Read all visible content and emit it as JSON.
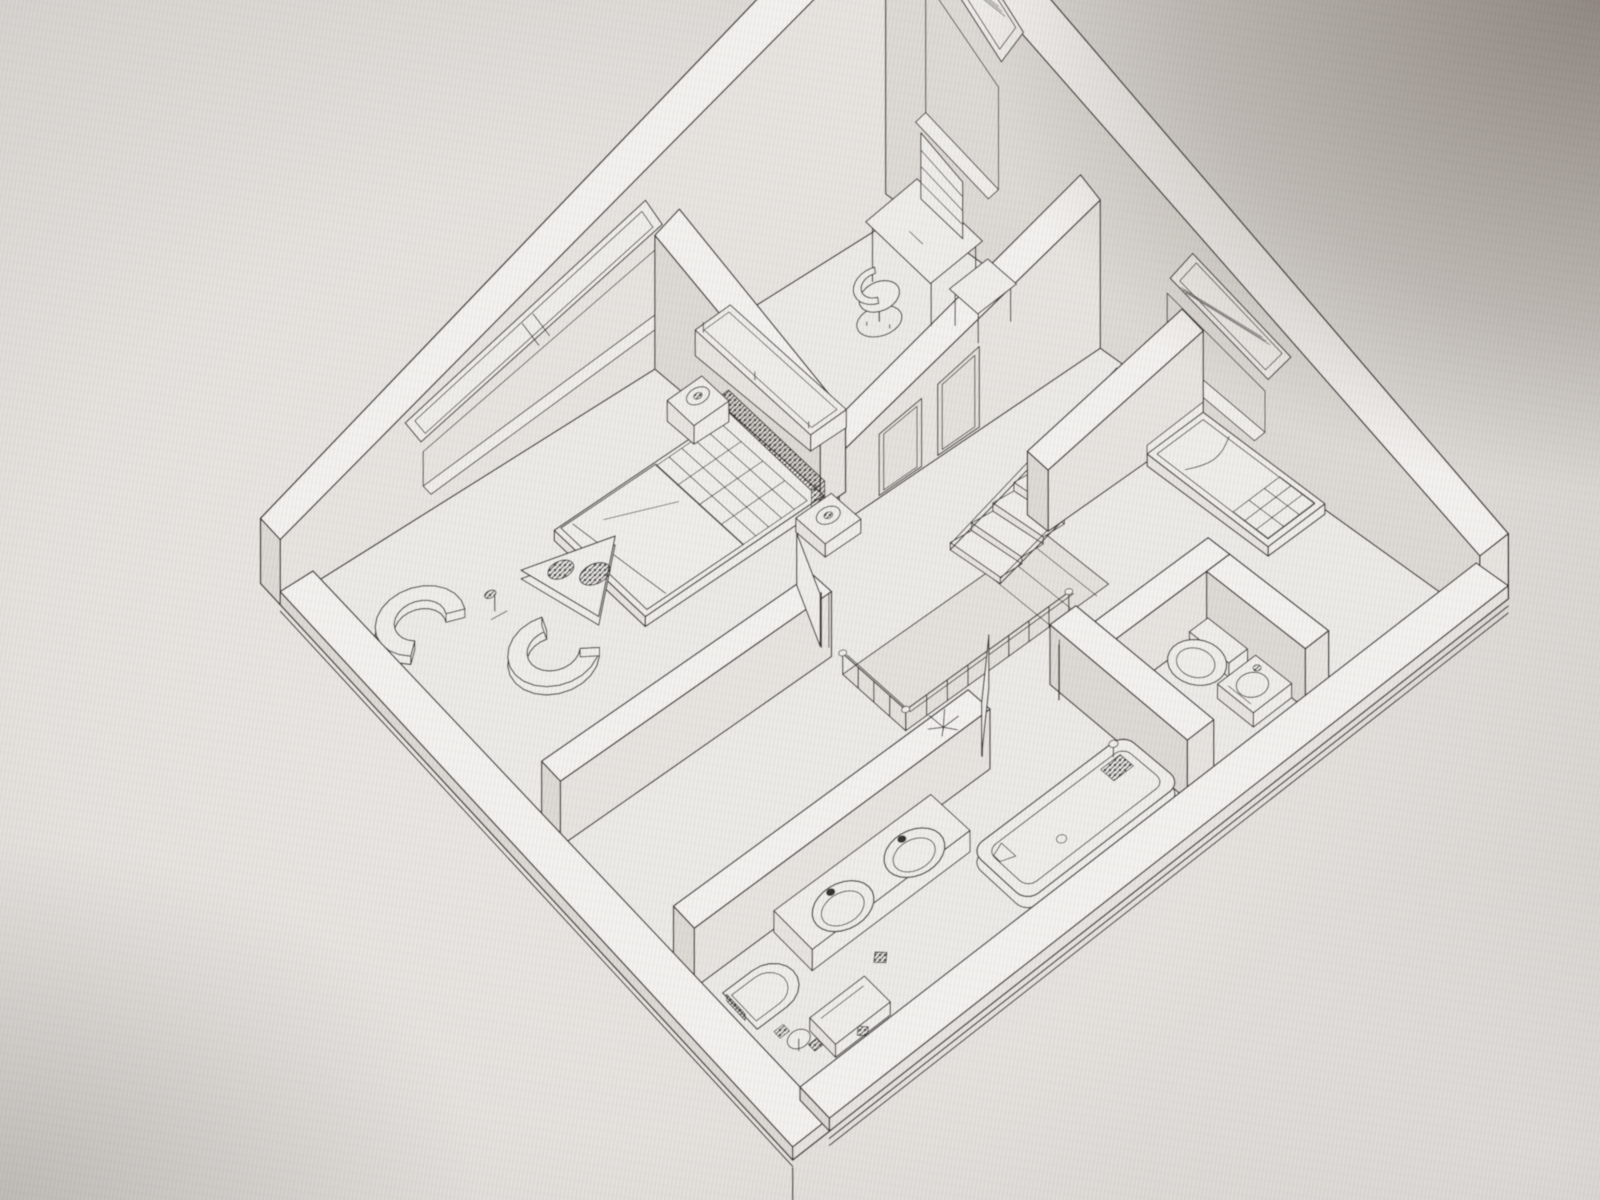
{
  "meta": {
    "description": "Photograph of a monitor displaying a black-and-white 3D axonometric wireframe floor plan of an apartment, rotated 45 degrees (diamond orientation)",
    "drawing_type": "3d-floorplan-wireframe",
    "text_content": "none"
  },
  "style": {
    "line": "#3e3b38",
    "line_soft": "#565350",
    "floor": "#edebe7",
    "hole": "#e5e2dd",
    "wall_top": "#f4f2ef",
    "wall_face": "#e8e5e1",
    "wall_face_dark": "#dedad5",
    "paper": "#f0eeea",
    "hatch": "#33302d"
  },
  "projection": {
    "floor_corners_screen": [
      [
        313,
        584
      ],
      [
        908,
        210
      ],
      [
        1448,
        598
      ],
      [
        800,
        1100
      ]
    ],
    "plan_min": 0.45,
    "plan_max": 9.55,
    "k_base": 26,
    "k_gain": 440,
    "wall_height_m": 2.5
  },
  "floor": {
    "rect": [
      0.45,
      0.45,
      9.55,
      9.55
    ]
  },
  "stair_hole": {
    "rect": [
      4.08,
      5.78,
      7.05,
      6.85
    ]
  },
  "exterior_walls": [
    {
      "name": "wall-northwest",
      "rect": [
        0,
        0,
        10,
        0.45
      ],
      "h": 2.5
    },
    {
      "name": "wall-northeast",
      "rect": [
        9.55,
        0,
        10,
        10
      ],
      "h": 2.5
    },
    {
      "name": "wall-southwest-low",
      "rect": [
        0,
        0.45,
        0.45,
        10
      ],
      "h": 0.5
    },
    {
      "name": "wall-southeast-low",
      "rect": [
        0.45,
        9.55,
        10,
        10
      ],
      "h": 0.5
    }
  ],
  "interior_walls": [
    {
      "name": "wall-office-hall",
      "rect": [
        5.45,
        3.7,
        9.55,
        4.05
      ],
      "h": 2.5,
      "openings": [
        [
          6.05,
          6.7
        ],
        [
          6.95,
          7.6
        ]
      ]
    },
    {
      "name": "wall-bedroom-office",
      "rect": [
        5.45,
        0.45,
        5.83,
        3.7
      ],
      "h": 2.5
    },
    {
      "name": "wall-stairs-bedroom2",
      "rect": [
        7.1,
        5.45,
        9.55,
        5.8
      ],
      "h": 2.2
    },
    {
      "name": "wall-bedroom-hall",
      "rect": [
        0.45,
        5.15,
        4.15,
        5.5
      ],
      "h": 2.5
    },
    {
      "name": "wall-bath-wc",
      "rect": [
        5.62,
        7.45,
        6.0,
        9.55
      ],
      "h": 2.3
    },
    {
      "name": "wall-wc-north",
      "rect": [
        6.0,
        7.75,
        7.7,
        8.08
      ],
      "h": 2.3
    },
    {
      "name": "wall-wc-east",
      "rect": [
        7.35,
        8.08,
        7.7,
        9.55
      ],
      "h": 2.3
    },
    {
      "name": "wall-bath-hall",
      "rect": [
        0.45,
        7.5,
        4.4,
        7.85
      ],
      "h": 2.3
    }
  ],
  "windows": [
    {
      "name": "window-master-bedroom",
      "wall": "nw",
      "span": [
        2.0,
        5.6
      ],
      "mullion": true
    },
    {
      "name": "window-office",
      "wall": "ne",
      "span": [
        0.8,
        2.2
      ],
      "mullion": false
    },
    {
      "name": "window-bedroom2",
      "wall": "ne",
      "span": [
        5.2,
        6.8
      ],
      "mullion": false
    }
  ],
  "stairs": {
    "name": "staircase",
    "v0": 4.55,
    "v1": 5.42,
    "u_top": 9.35,
    "steps": 8,
    "step_u": 0.33,
    "step_z": 0.235
  },
  "railing": {
    "name": "stair-railing",
    "h": 0.8,
    "rails": [
      [
        [
          4.08,
          5.78
        ],
        [
          4.08,
          6.85
        ]
      ],
      [
        [
          4.08,
          6.85
        ],
        [
          6.45,
          6.85
        ]
      ]
    ]
  },
  "doors": [
    {
      "name": "door-master-bedroom",
      "hinge": [
        4.15,
        5.3
      ],
      "tip": [
        4.52,
        4.42
      ],
      "h": 2.0,
      "jambs": [
        [
          4.15,
          5.32
        ]
      ]
    },
    {
      "name": "door-bathroom",
      "hinge": [
        4.45,
        7.66
      ],
      "tip": [
        5.12,
        7.02
      ],
      "h": 2.0,
      "jambs": [
        [
          4.45,
          7.67
        ],
        [
          5.55,
          7.67
        ]
      ]
    }
  ],
  "furniture": [
    {
      "name": "office-bench",
      "type": "bench",
      "rect": [
        5.95,
        0.62,
        6.5,
        2.9
      ]
    },
    {
      "name": "office-desk",
      "type": "desk",
      "rect": [
        8.3,
        1.1,
        9.15,
        2.35
      ]
    },
    {
      "name": "office-side-table",
      "type": "sidetable",
      "rect": [
        8.52,
        2.45,
        9.15,
        2.98
      ]
    },
    {
      "name": "office-chair",
      "type": "deskchair",
      "c": [
        7.92,
        1.82
      ]
    },
    {
      "name": "double-bed",
      "type": "bed",
      "rect": [
        2.9,
        1.9,
        5.5,
        3.7
      ]
    },
    {
      "name": "nightstand-left",
      "type": "nightstand",
      "rect": [
        5.02,
        1.28,
        5.55,
        1.82
      ]
    },
    {
      "name": "nightstand-right",
      "type": "nightstand",
      "rect": [
        5.02,
        3.78,
        5.55,
        4.32
      ]
    },
    {
      "name": "armchair-1",
      "type": "tubchair",
      "c": [
        0.98,
        1.95
      ],
      "ang": 80
    },
    {
      "name": "armchair-2",
      "type": "tubchair",
      "c": [
        1.85,
        3.38
      ],
      "ang": -15
    },
    {
      "name": "corner-table",
      "type": "tritable",
      "pts": [
        [
          2.25,
          2.15
        ],
        [
          3.35,
          2.5
        ],
        [
          2.5,
          3.35
        ]
      ]
    },
    {
      "name": "floor-lamp",
      "type": "floorlamp",
      "c": [
        1.78,
        2.3
      ]
    },
    {
      "name": "single-bed",
      "type": "singlebed",
      "rect": [
        8.6,
        5.85,
        9.5,
        7.78
      ]
    },
    {
      "name": "wc-toilet",
      "type": "toilet_round",
      "c": [
        6.95,
        8.42
      ]
    },
    {
      "name": "wc-basin-cabinet",
      "type": "basin_cabinet",
      "rect": [
        6.78,
        8.82,
        7.35,
        9.35
      ]
    },
    {
      "name": "vanity-double-sink",
      "type": "vanity",
      "rect": [
        1.45,
        7.88,
        3.55,
        8.5
      ]
    },
    {
      "name": "toilet-wall-hung",
      "type": "toilet_wallhung",
      "c": [
        0.88,
        8.47
      ]
    },
    {
      "name": "small-basin",
      "type": "basin_small",
      "rect": [
        1.0,
        9.02,
        1.7,
        9.42
      ]
    },
    {
      "name": "bathtub",
      "type": "bathtub",
      "rect": [
        3.45,
        8.62,
        5.6,
        9.48
      ]
    },
    {
      "name": "floor-drain-1",
      "type": "drain",
      "c": [
        2.05,
        8.85
      ],
      "s": 0.17
    },
    {
      "name": "floor-drain-2",
      "type": "drain",
      "c": [
        1.38,
        9.38
      ],
      "s": 0.14
    },
    {
      "name": "hall-plant",
      "type": "plant",
      "c": [
        4.38,
        7.12
      ]
    }
  ]
}
